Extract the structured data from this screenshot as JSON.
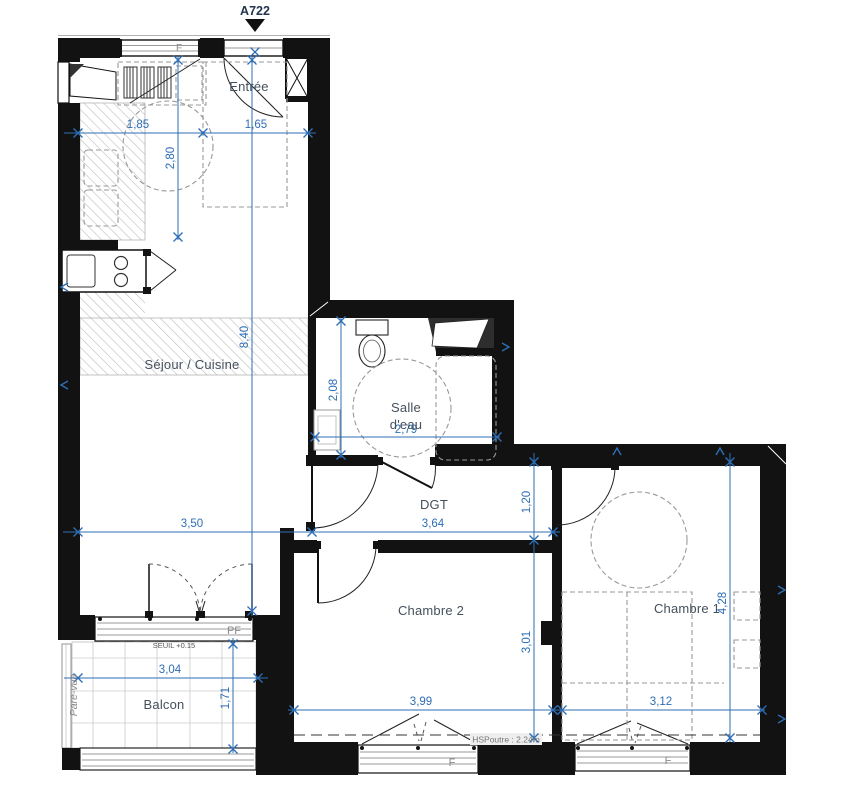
{
  "plan": {
    "reference": "A722",
    "rooms": {
      "entree": "Entrée",
      "sejour_cuisine": "Séjour / Cuisine",
      "salle_deau_l1": "Salle",
      "salle_deau_l2": "d'eau",
      "dgt": "DGT",
      "chambre2": "Chambre 2",
      "chambre1": "Chambre 1",
      "balcon": "Balcon"
    },
    "dimensions": {
      "kitchen_w1": "1,85",
      "kitchen_w2": "1,65",
      "kitchen_h": "2,80",
      "sejour_h": "8,40",
      "bath_h": "2,08",
      "bath_w": "2,79",
      "sejour_w": "3,50",
      "dgt_w": "3,64",
      "dgt_h": "1,20",
      "chambre2_h": "3,01",
      "chambre1_h": "4,28",
      "chambre2_w": "3,99",
      "chambre1_w": "3,12",
      "balcon_w": "3,04",
      "balcon_h": "1,71"
    },
    "annotations": {
      "seuil": "SEUIL +0.15",
      "hs_poutre": "HSPoutre : 2.24m",
      "pare_vue": "Pare-vue",
      "window_pf": "PF",
      "window_f_top": "F",
      "window_f_ch2": "F",
      "window_f_ch1": "F"
    },
    "colors": {
      "wall": "#121212",
      "dimension": "#2e6eb5",
      "room_label": "#44505c",
      "furniture": "#999999",
      "annotation": "#8a8a8a"
    }
  }
}
